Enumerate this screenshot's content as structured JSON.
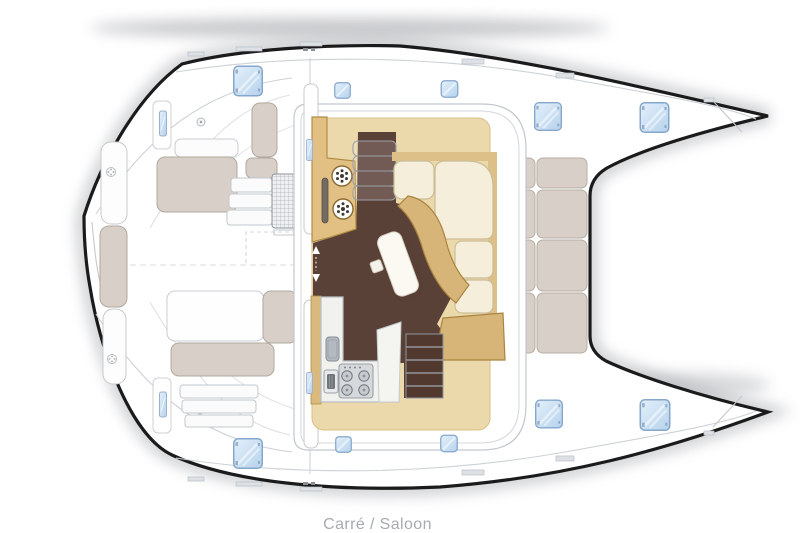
{
  "caption": {
    "text": "Carré / Saloon"
  },
  "palette": {
    "hull_outline": "#1b1b1b",
    "deck_white": "#ffffff",
    "detail_line_gray": "#cdd2d9",
    "hatch_blue_fill": "#cde2f6",
    "hatch_blue_border": "#86a7cc",
    "wood_counter": "#e2c083",
    "wood_floor": "#ecd9ab",
    "wood_bench": "#d7b578",
    "dark_floor_brown": "#5a4138",
    "cream_cushion": "#f5eedb",
    "greige_cushion": "#d8d0c8",
    "appliance_gray": "#d6d9db",
    "caption_gray": "#a6abb1"
  }
}
